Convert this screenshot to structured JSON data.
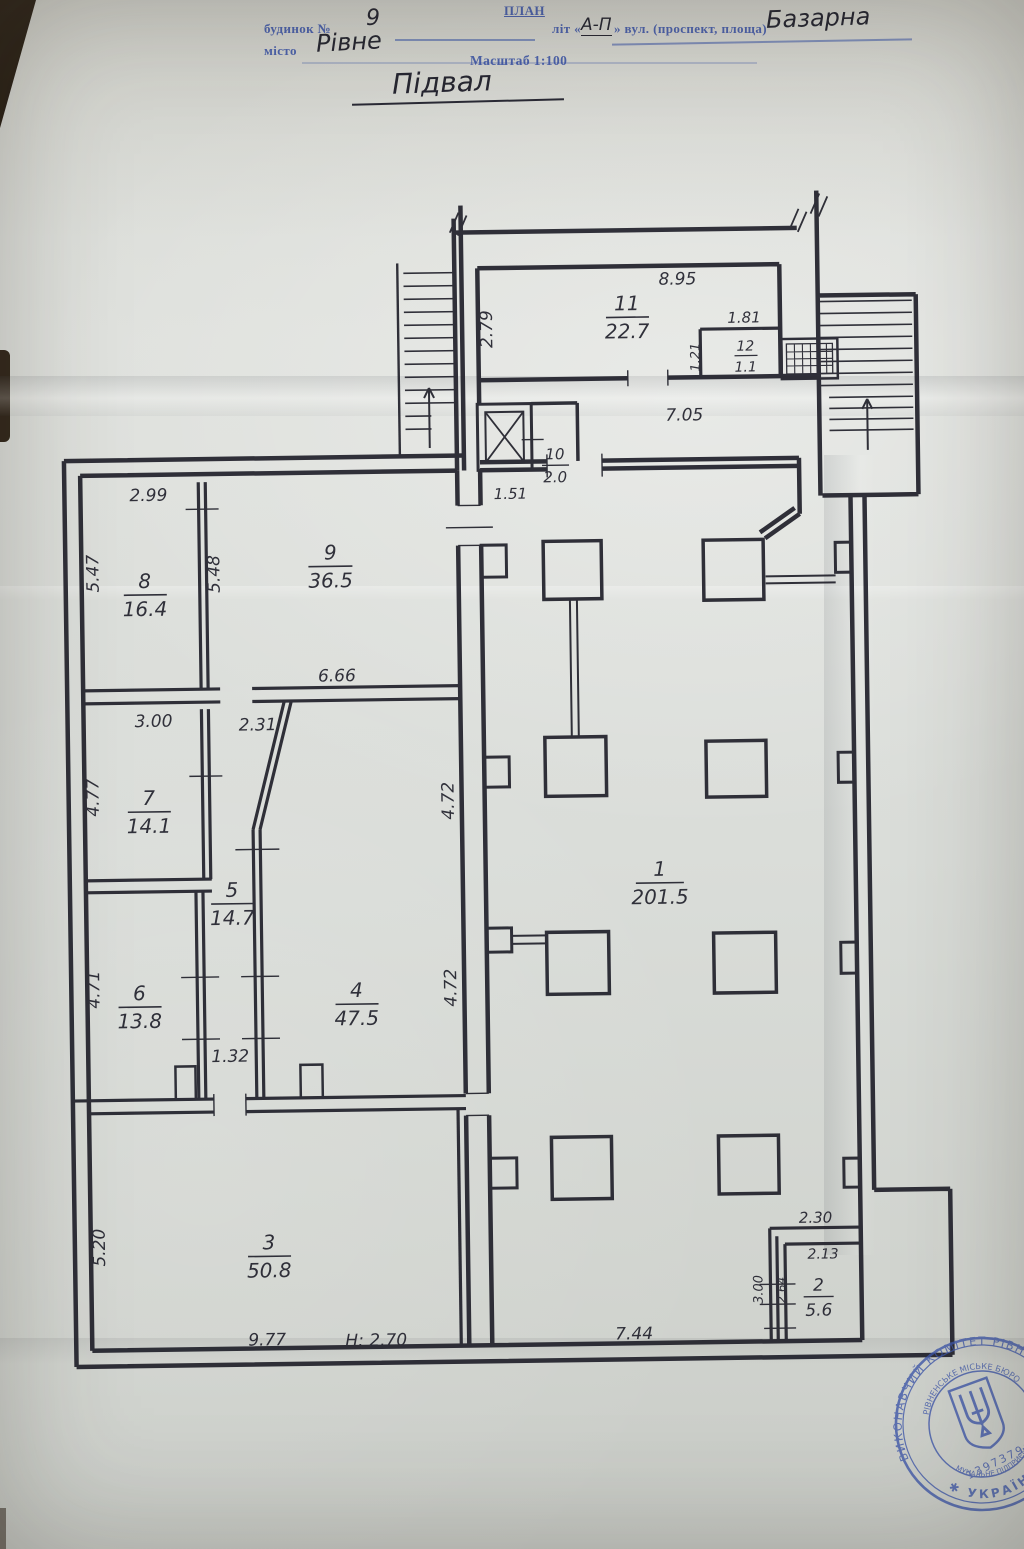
{
  "header": {
    "form_title": "ПЛАН",
    "building_label": "будинок №",
    "building_number": "9",
    "letter_label_pre": "літ «",
    "letter_value": "А-П",
    "letter_label_post": "» вул. (проспект, площа)",
    "street_value": "Базарна",
    "city_label": "місто",
    "city_value": "Рівне",
    "scale_label": "Масштаб 1:100",
    "plan_title": "Підвал"
  },
  "rooms": {
    "r1": {
      "n": "1",
      "a": "201.5"
    },
    "r2": {
      "n": "2",
      "a": "5.6"
    },
    "r3": {
      "n": "3",
      "a": "50.8"
    },
    "r4": {
      "n": "4",
      "a": "47.5"
    },
    "r5": {
      "n": "5",
      "a": "14.7"
    },
    "r6": {
      "n": "6",
      "a": "13.8"
    },
    "r7": {
      "n": "7",
      "a": "14.1"
    },
    "r8": {
      "n": "8",
      "a": "16.4"
    },
    "r9": {
      "n": "9",
      "a": "36.5"
    },
    "r10": {
      "n": "10",
      "a": "2.0"
    },
    "r11": {
      "n": "11",
      "a": "22.7"
    },
    "r12": {
      "n": "12",
      "a": "1.1"
    }
  },
  "dims": {
    "v299": "2.99",
    "v547": "5.47",
    "v548": "5.48",
    "v666": "6.66",
    "v300": "3.00",
    "v231": "2.31",
    "v477": "4.77",
    "v472a": "4.72",
    "v472b": "4.72",
    "v471": "4.71",
    "v132": "1.32",
    "v520": "5.20",
    "v977": "9.77",
    "vh270": "Н: 2.70",
    "v744": "7.44",
    "v895": "8.95",
    "v279": "2.79",
    "v181": "1.81",
    "v121": "1.21",
    "v705": "7.05",
    "v151": "1.51",
    "v230": "2.30",
    "v213": "2.13",
    "v300b": "3.00",
    "v264": "2.64"
  },
  "stamp": {
    "outer_text": "ВИКОНАВЧИЙ КОМІТЕТ РІВНЕНСЬКОЇ",
    "inner_text": "РІВНЕНСЬКЕ МІСЬКЕ БЮРО",
    "inner_text2": "КОМУНАЛЬНЕ ПІДПРИЄМСТВО",
    "number": "13973796",
    "country": "✱ УКРАЇНА ✱"
  },
  "colors": {
    "ink": "#23232e",
    "print_blue": "#3a53a6",
    "stamp_blue": "#3d56a9"
  }
}
